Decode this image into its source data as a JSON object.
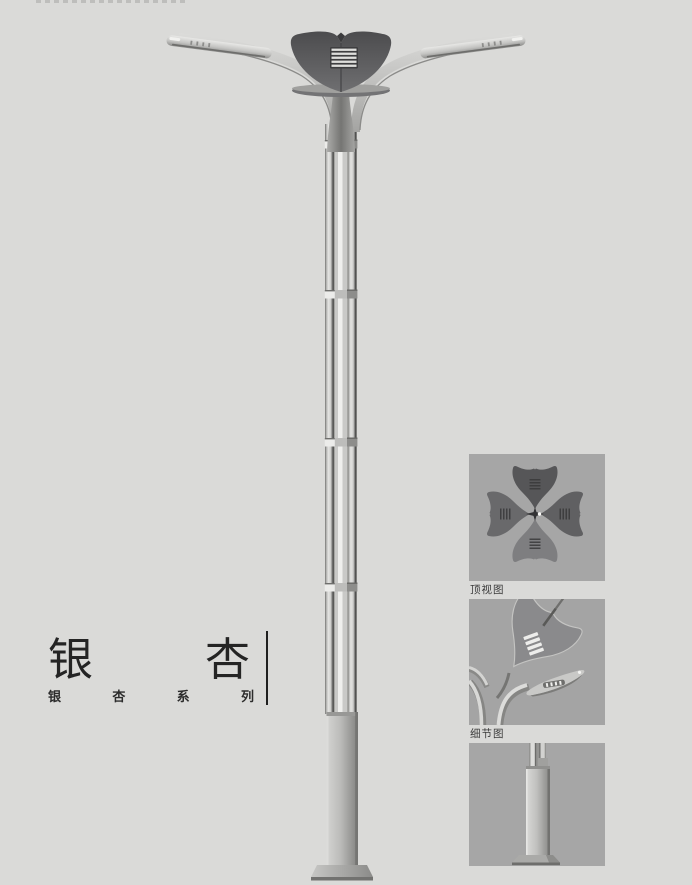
{
  "page": {
    "background": "#dadad8"
  },
  "title": {
    "name": "银杏",
    "chars": [
      "银",
      "杏"
    ],
    "series": "银杏系列",
    "series_chars": [
      "银",
      "杏",
      "系",
      "列"
    ]
  },
  "main_figure": {
    "name": "ginkgo-street-lamp-render"
  },
  "thumbnails": [
    {
      "name": "top-view-render",
      "label": "顶视图"
    },
    {
      "name": "detail-view-render",
      "label": "细节图"
    },
    {
      "name": "base-view-render",
      "label": ""
    }
  ],
  "colors": {
    "background": "#dadad8",
    "panel": "#a6a6a6",
    "ink": "#242424",
    "lamp_dark": "#565658",
    "metal_light": "#dcdcda"
  }
}
